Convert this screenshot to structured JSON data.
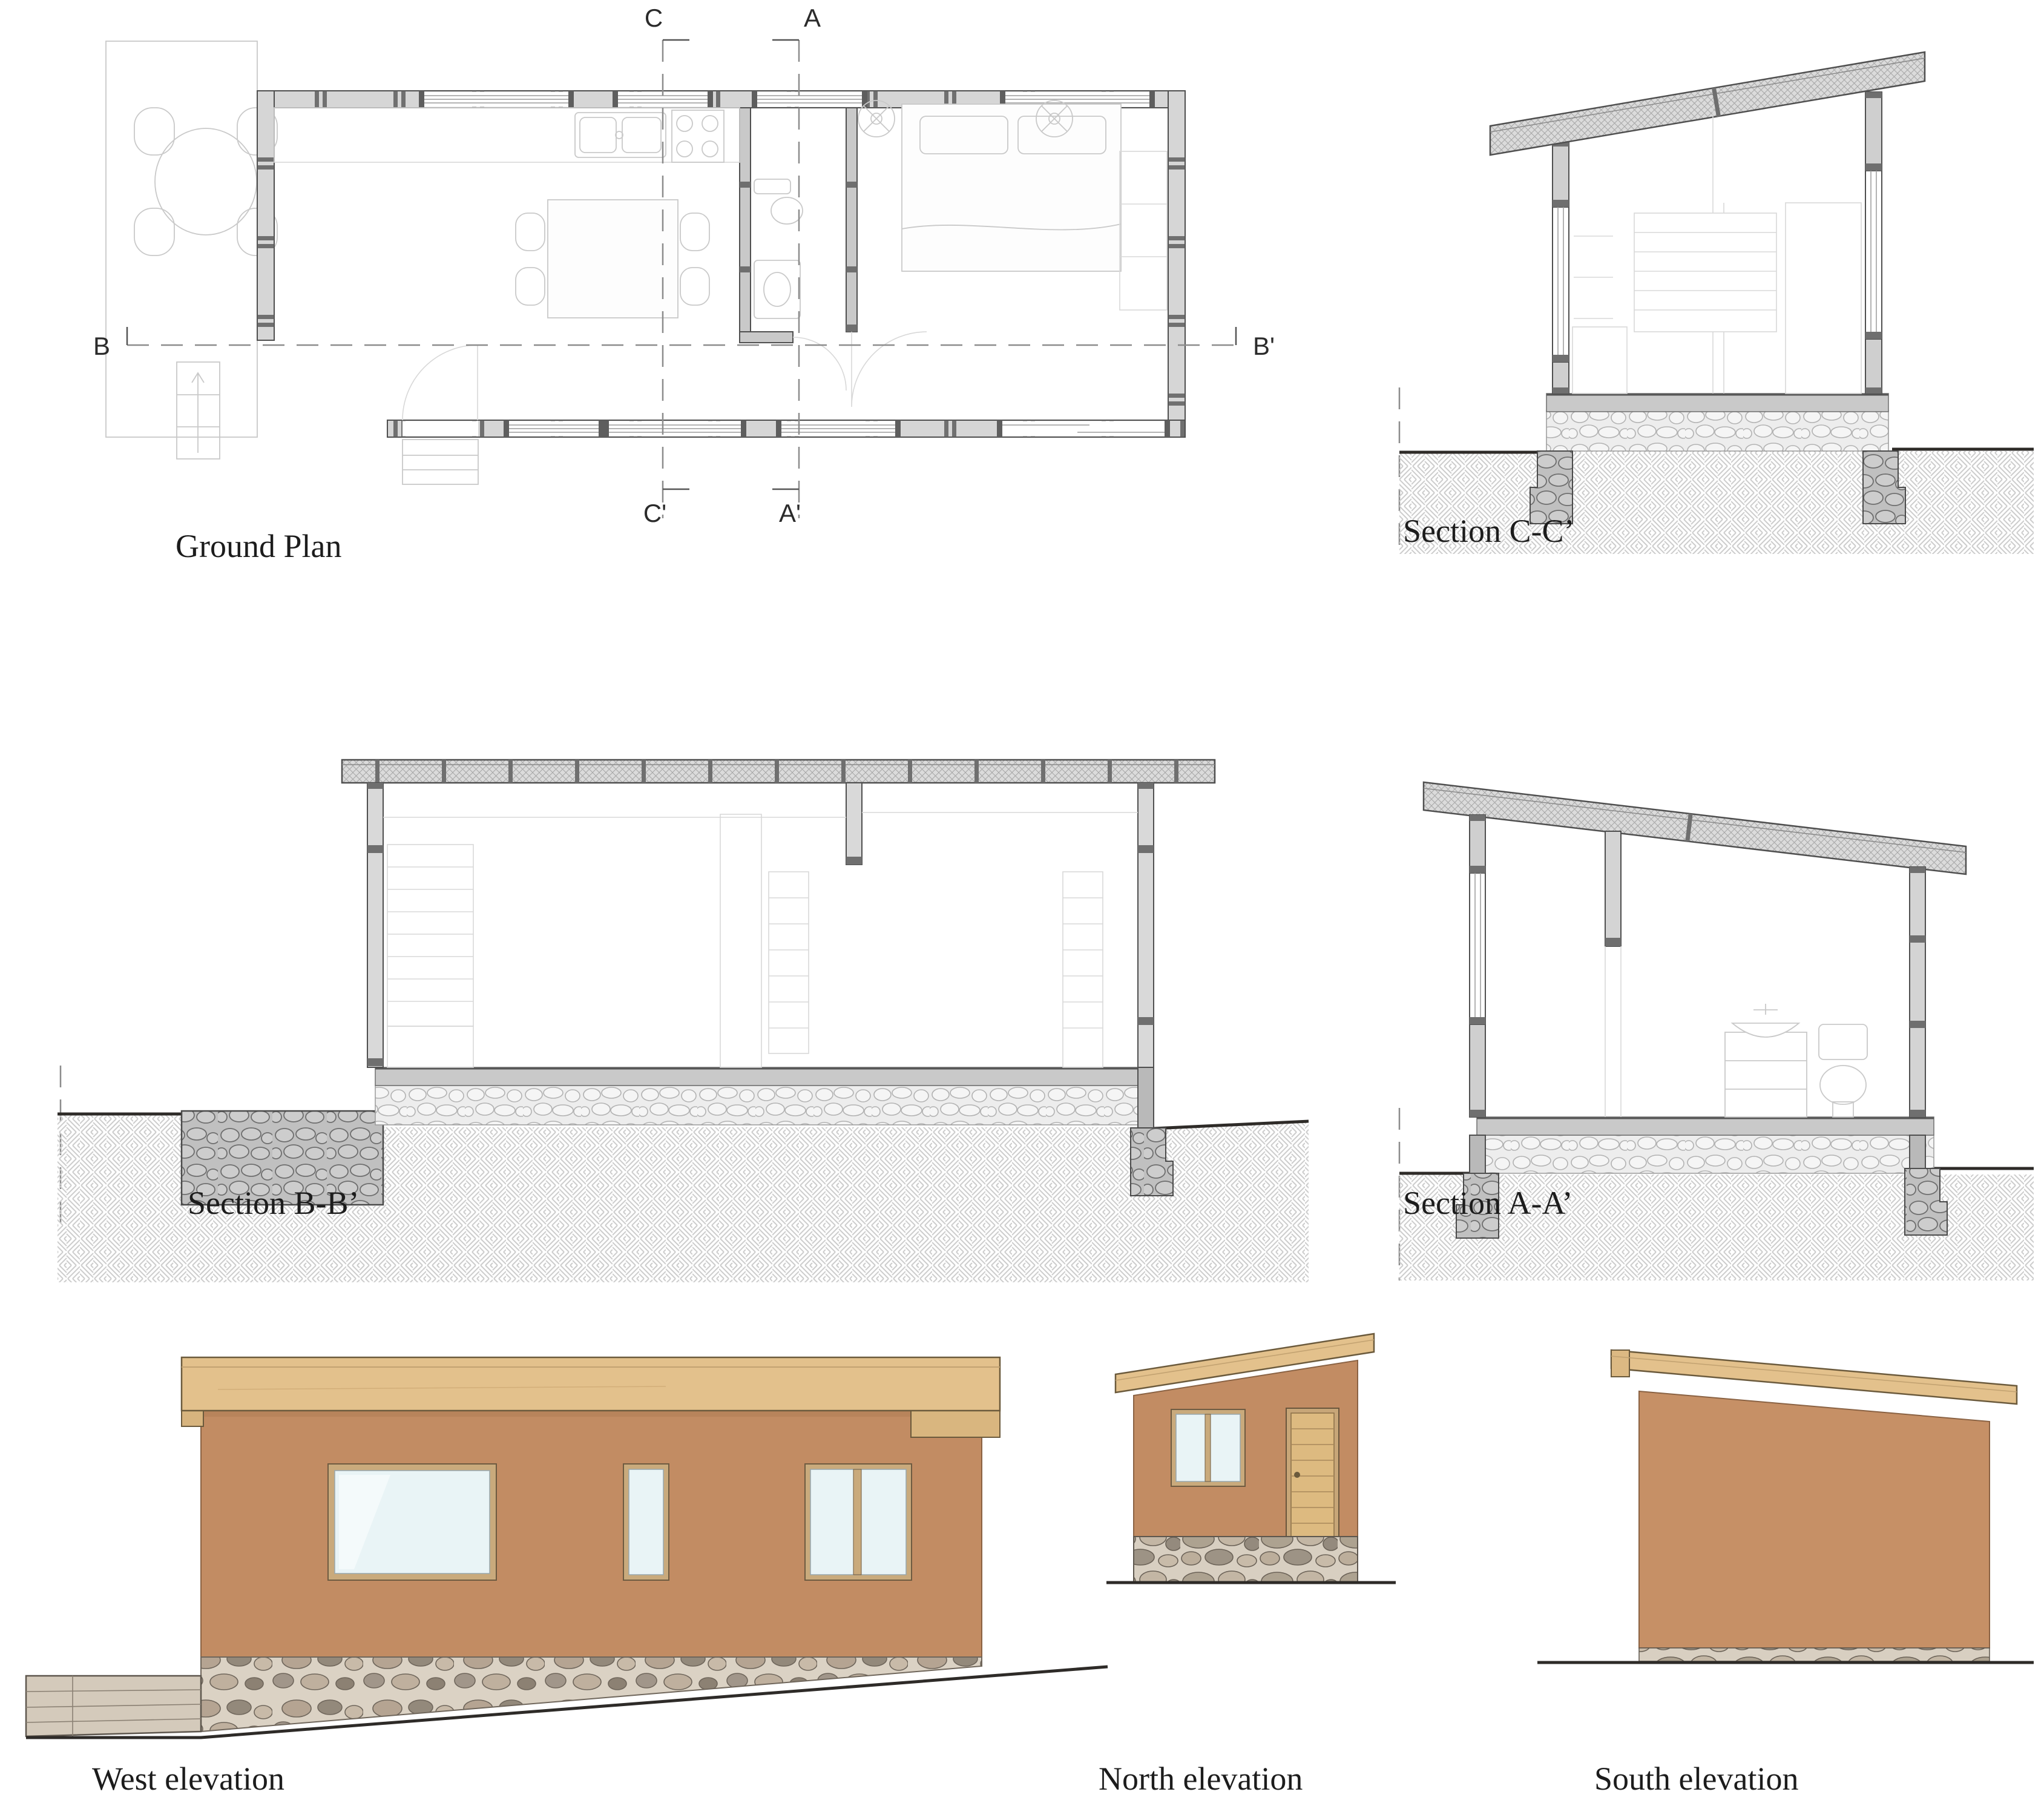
{
  "sheet": {
    "type": "architectural drawing sheet",
    "background": "#ffffff"
  },
  "panels": {
    "ground_plan": {
      "label": "Ground Plan"
    },
    "section_cc": {
      "label": "Section C-C’"
    },
    "section_bb": {
      "label": "Section B-B’"
    },
    "section_aa": {
      "label": "Section A-A’"
    },
    "west_elevation": {
      "label": "West elevation"
    },
    "north_elevation": {
      "label": "North elevation"
    },
    "south_elevation": {
      "label": "South elevation"
    }
  },
  "markers": {
    "c": "C",
    "a": "A",
    "b": "B",
    "b_prime": "B'",
    "c_prime": "C'",
    "a_prime": "A'"
  },
  "colors": {
    "adobe_wall": "#c28c63",
    "wood_roof": "#e3c18c",
    "door_wood": "#ddba80",
    "window_glass": "#e9f4f6",
    "window_frame": "#c9aa7c",
    "cut_wall_gray": "#d6d6d6",
    "stone_foundation": "#d7ccbd",
    "drawing_line": "#4f4f4f"
  }
}
